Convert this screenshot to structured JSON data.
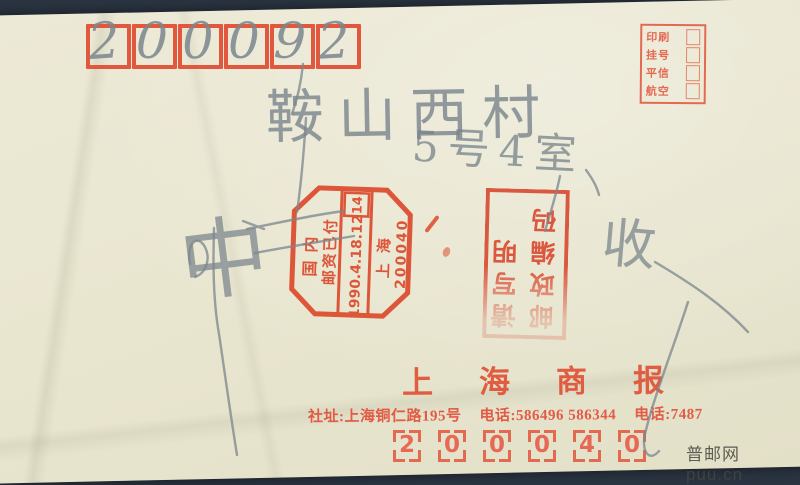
{
  "scan": {
    "background_color": "#2b3542",
    "envelope_color": "#e9e6d0",
    "stamp_red": "#dc4a2c",
    "pencil_gray": "#76828a"
  },
  "top_left_postcode": {
    "digits": [
      "2",
      "0",
      "0",
      "0",
      "9",
      "2"
    ]
  },
  "mail_type_box": {
    "rows": [
      {
        "label": "印刷"
      },
      {
        "label": "挂号"
      },
      {
        "label": "平信"
      },
      {
        "label": "航空"
      }
    ]
  },
  "handwriting": {
    "address_line1": "鞍山西村",
    "address_line2": "5号4室",
    "big_char": "中",
    "receive_char": "收"
  },
  "postmark": {
    "shape": "octagon, rotated 90° counterclockwise",
    "line1": "国内",
    "line2": "邮资已付",
    "date": "1990.4.18.12",
    "machine_no": "14",
    "city": "上海",
    "zone_code": "200040"
  },
  "code_stamp": {
    "note": "rotated 180°",
    "col_right": "请写明",
    "col_left": "邮政编码"
  },
  "masthead": {
    "title": "上海商报"
  },
  "footer_line": {
    "address": "社址:上海铜仁路195号",
    "phone1": "电话:586496 586344",
    "phone2": "电话:7487"
  },
  "bottom_postcode": {
    "digits": [
      "2",
      "0",
      "0",
      "0",
      "4",
      "0"
    ]
  },
  "watermark": {
    "text": "普邮网 puu.cn"
  }
}
